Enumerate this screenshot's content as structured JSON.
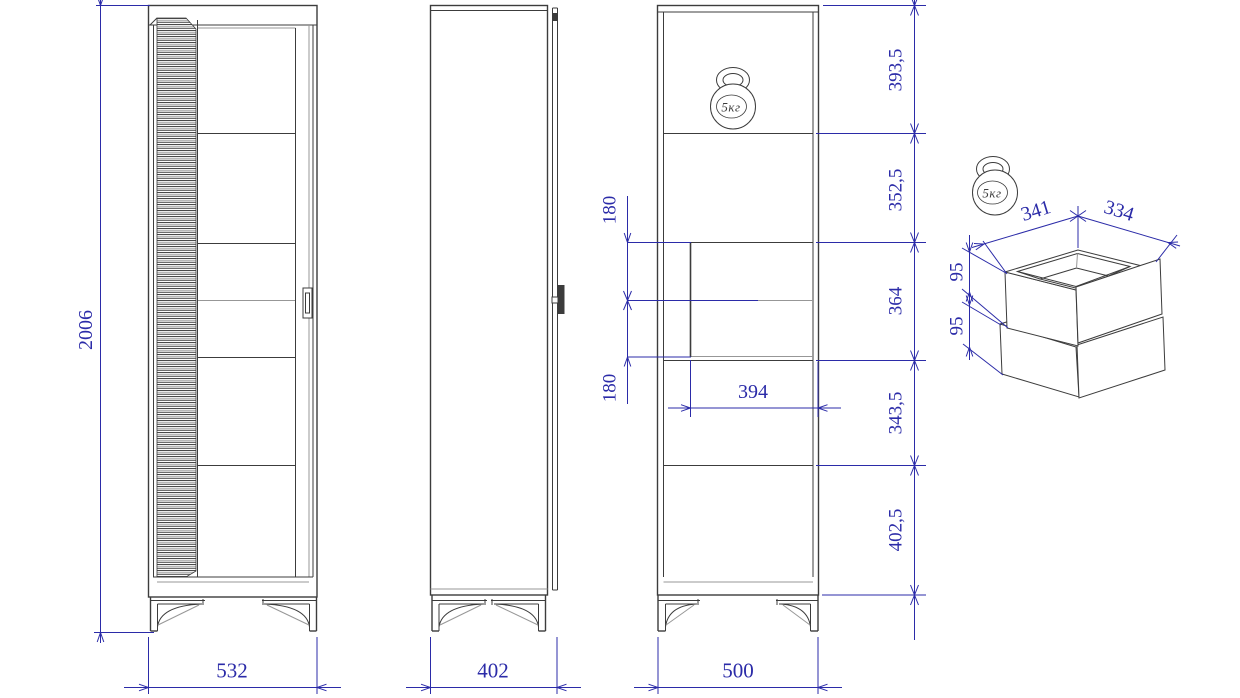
{
  "drawing_type": "furniture-cabinet-dimension-drawing",
  "views": {
    "front": {
      "width": "532",
      "height": "2006"
    },
    "side": {
      "depth": "402"
    },
    "section": {
      "width": "500",
      "drawer_width": "394",
      "drawer_offsets": [
        "180",
        "180"
      ],
      "heights": [
        "393,5",
        "352,5",
        "364",
        "343,5",
        "402,5"
      ],
      "load": "5кг"
    },
    "detail": {
      "width": "341",
      "depth": "334",
      "drawer_heights": [
        "95",
        "95"
      ],
      "load": "5кг"
    }
  },
  "colors": {
    "line": "#3c3c3c",
    "dimension": "#2b2ba8",
    "background": "#ffffff"
  }
}
